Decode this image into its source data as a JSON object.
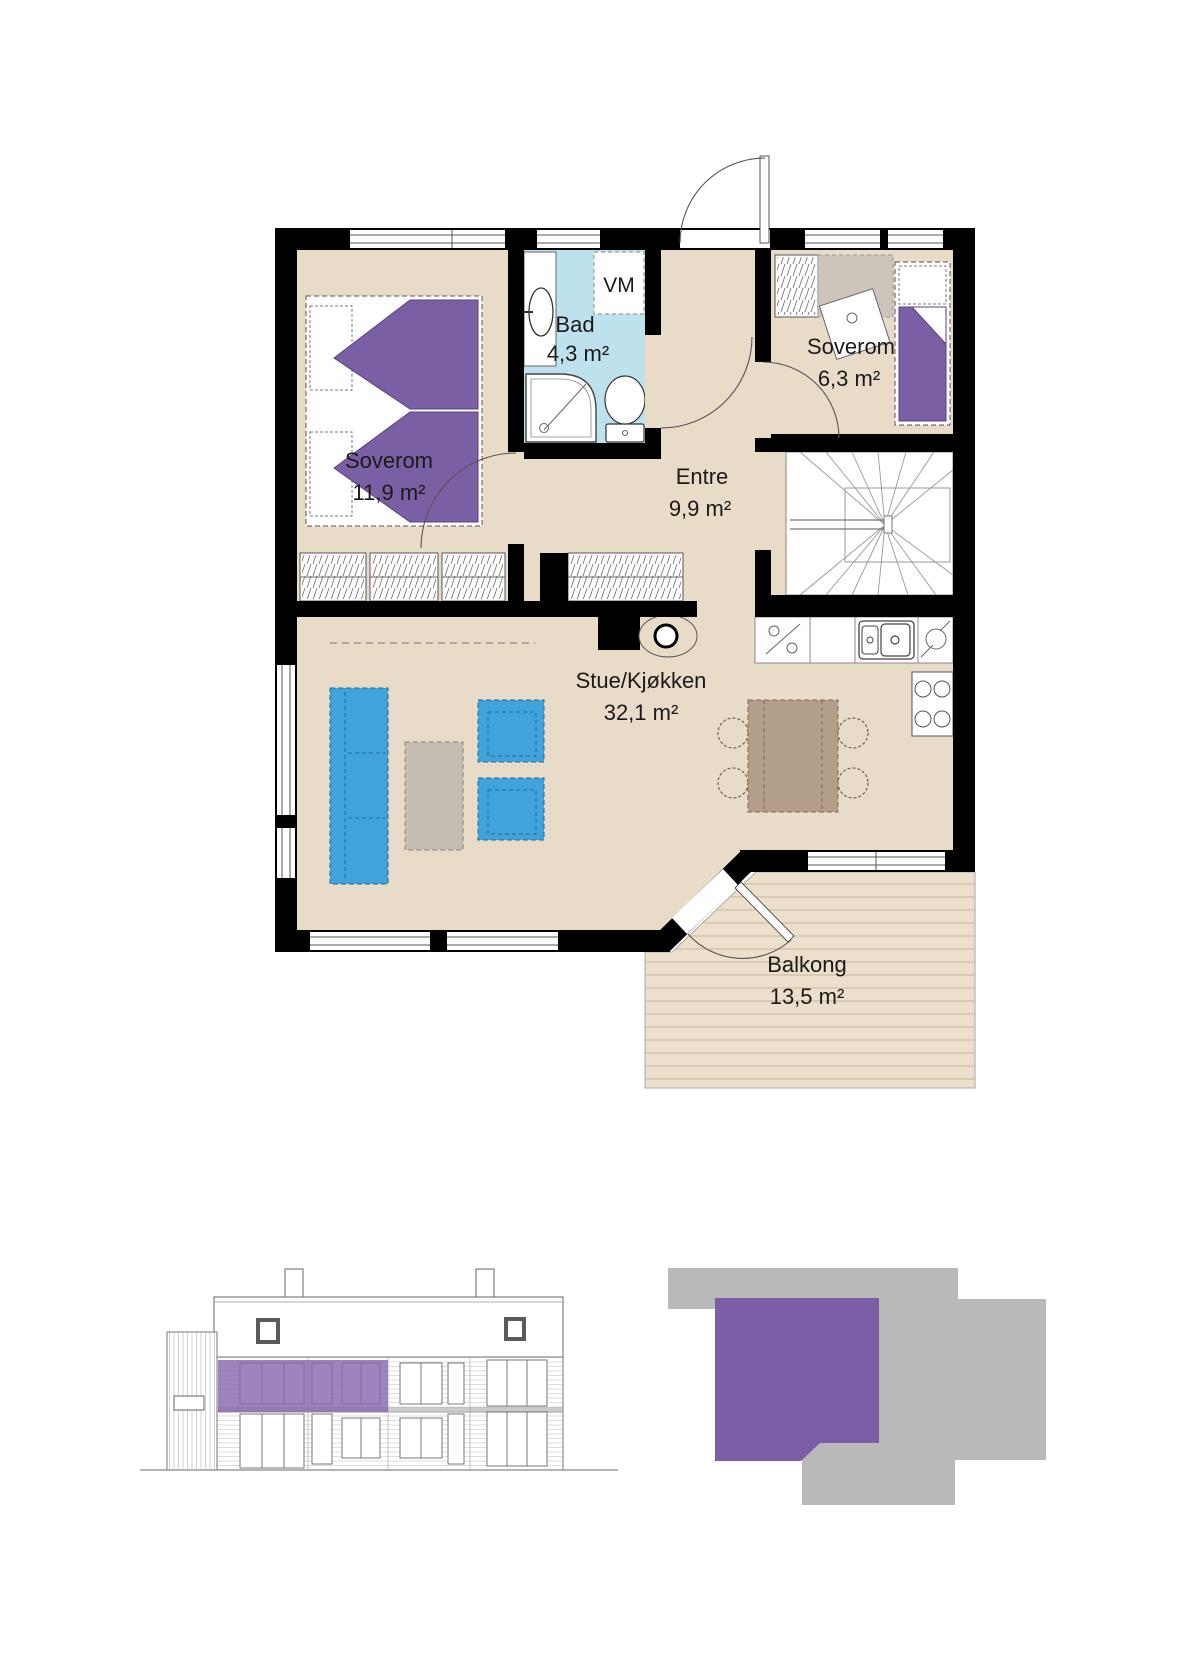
{
  "floor_plan": {
    "rooms": [
      {
        "id": "soverom-1",
        "label": "Soverom",
        "area": "11,9 m²"
      },
      {
        "id": "bad",
        "label": "Bad",
        "area": "4,3 m²"
      },
      {
        "id": "entre",
        "label": "Entre",
        "area": "9,9 m²"
      },
      {
        "id": "soverom-2",
        "label": "Soverom",
        "area": "6,3 m²"
      },
      {
        "id": "stue-kjokken",
        "label": "Stue/Kjøkken",
        "area": "32,1 m²"
      },
      {
        "id": "balkong",
        "label": "Balkong",
        "area": "13,5 m²"
      }
    ],
    "appliance_labels": {
      "washing_machine": "VM"
    },
    "fixtures": [
      "double-bed",
      "single-bed",
      "wardrobes",
      "washing-machine",
      "bathroom-sink",
      "shower",
      "toilet",
      "water-heater",
      "stairs",
      "kitchen-counter",
      "dishwasher",
      "kitchen-sink",
      "refrigerator",
      "cooktop",
      "sofa",
      "coffee-table",
      "armchairs",
      "dining-table-with-chairs",
      "balcony-deck"
    ],
    "colors": {
      "floor": "#e8dcc9",
      "bathroom_floor": "#bde2ee",
      "wall": "#000000",
      "bed_purple": "#7b5fa4",
      "furniture_blue": "#41a3da",
      "coffee_table_gray": "#c4bdb2",
      "dining_table_brown": "#b39e8a",
      "desk_zone_gray": "#cdc5bb",
      "balcony_deck": "#ecdfcb"
    }
  },
  "building_elevation": {
    "unit_highlight_color": "#8a68ad"
  },
  "site_diagram": {
    "building_color": "#b9b9b9",
    "unit_highlight_color": "#7d5ea6"
  }
}
